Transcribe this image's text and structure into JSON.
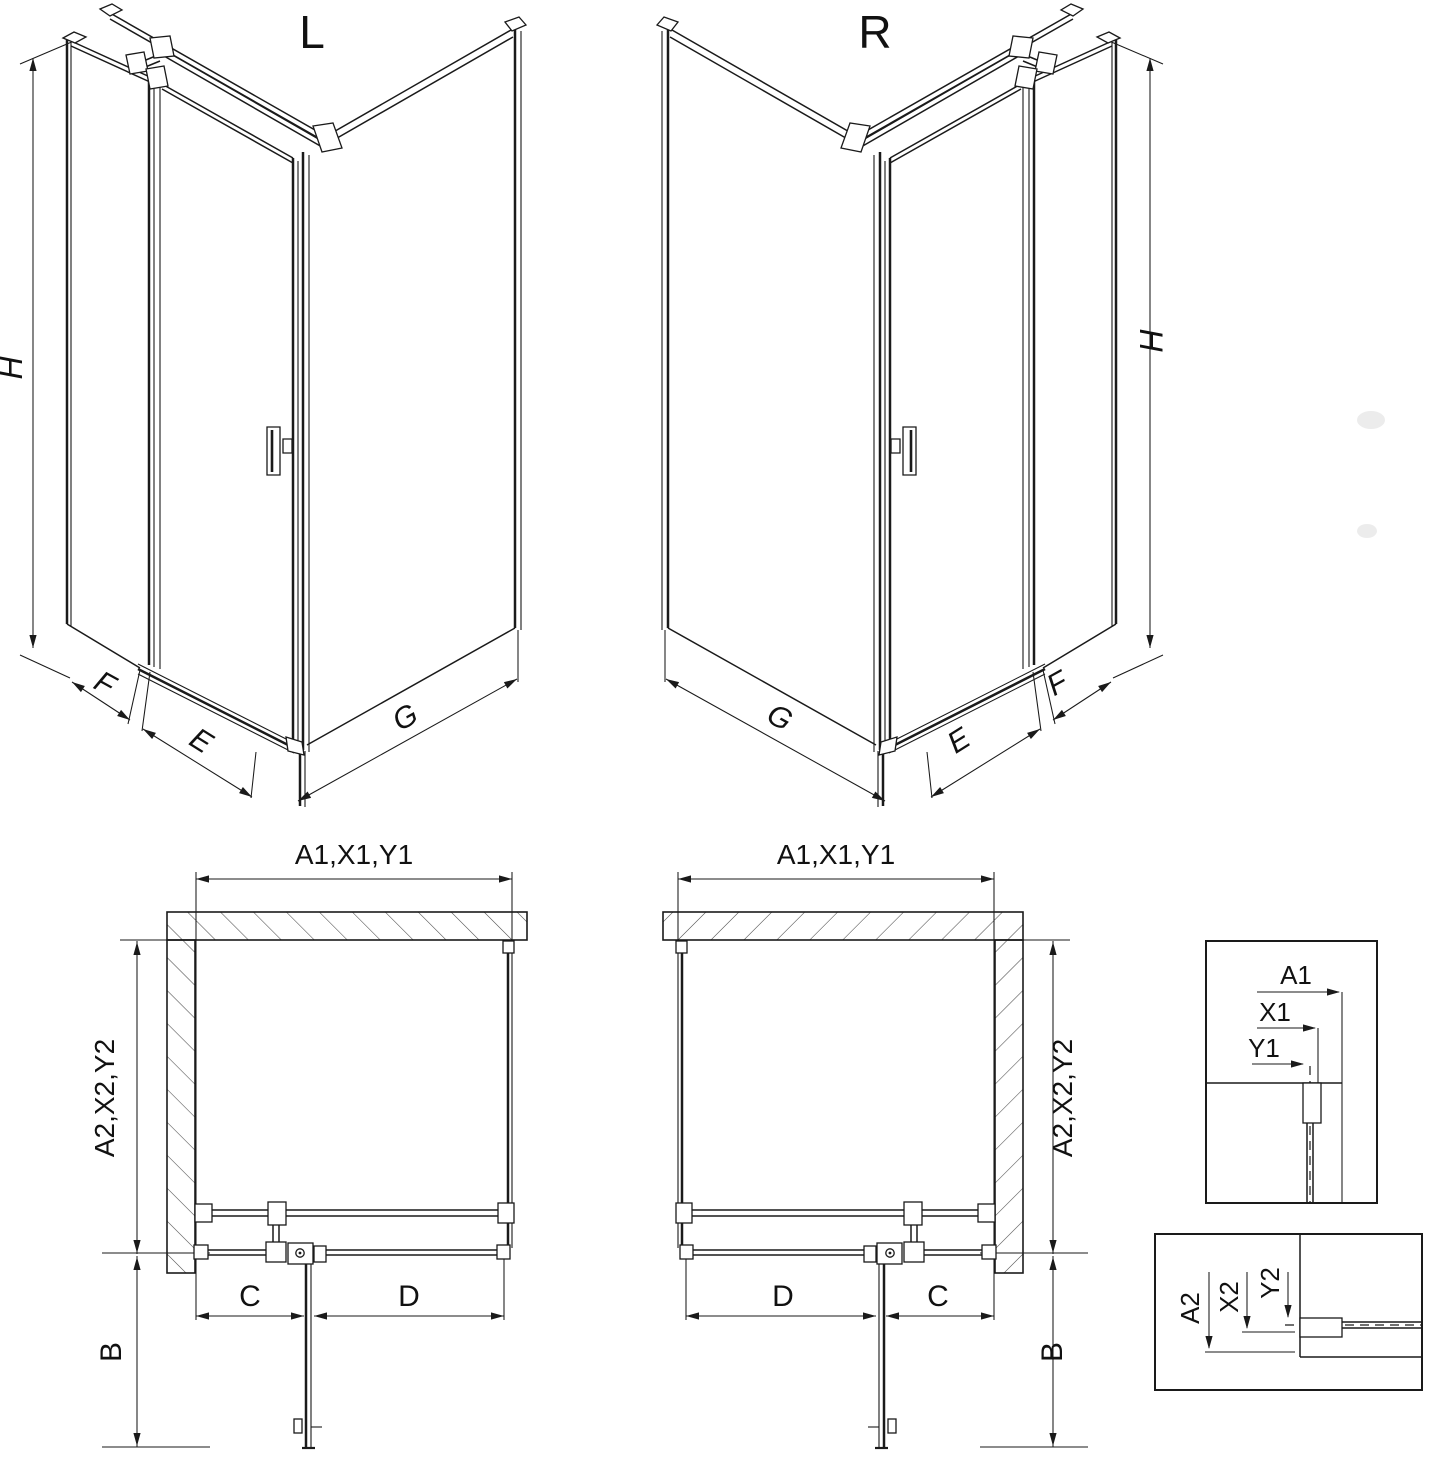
{
  "page": {
    "background": "#ffffff",
    "line_color": "#1a1a1a"
  },
  "iso": {
    "left": {
      "title": "L",
      "h": "H",
      "f": "F",
      "e": "E",
      "g": "G"
    },
    "right": {
      "title": "R",
      "h": "H",
      "f": "F",
      "e": "E",
      "g": "G"
    }
  },
  "plan": {
    "left": {
      "top_dim": "A1,X1,Y1",
      "side_dim": "A2,X2,Y2",
      "b": "B",
      "c": "C",
      "d": "D"
    },
    "right": {
      "top_dim": "A1,X1,Y1",
      "side_dim": "A2,X2,Y2",
      "b": "B",
      "c": "C",
      "d": "D"
    }
  },
  "details": {
    "top": {
      "a1": "A1",
      "x1": "X1",
      "y1": "Y1"
    },
    "bottom": {
      "a2": "A2",
      "x2": "X2",
      "y2": "Y2"
    }
  }
}
